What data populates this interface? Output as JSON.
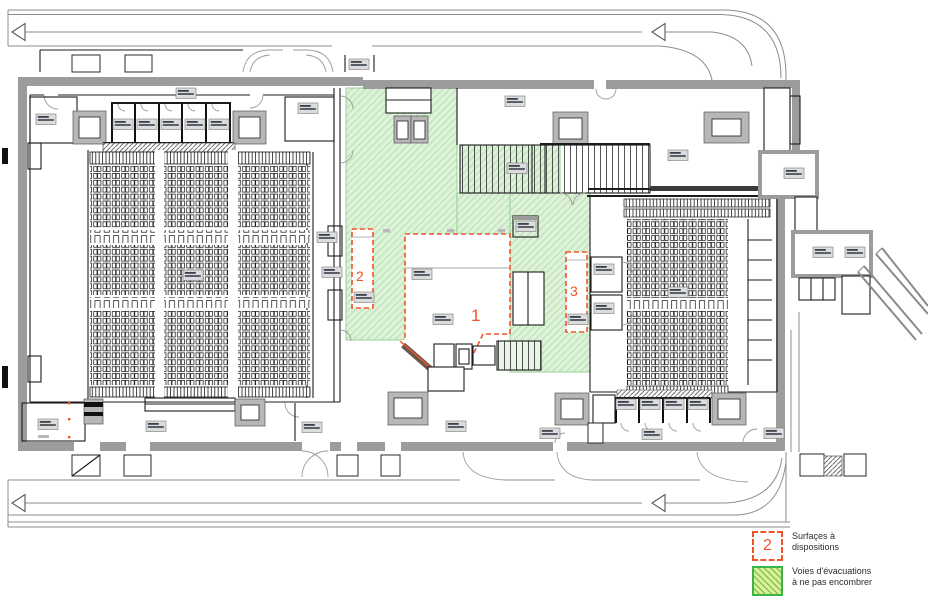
{
  "title": "Plan d'étage - salles et voies d'évacuation",
  "legend": {
    "surface": {
      "symbol": "2",
      "label": "Surfaçes à dispositions"
    },
    "evacuation": {
      "label": "Voies d'évacuations à ne pas encombrer"
    }
  },
  "zones": [
    {
      "number": "1"
    },
    {
      "number": "2"
    },
    {
      "number": "3"
    }
  ],
  "colors": {
    "accent_orange": "#f0542a",
    "green_fill": "#def2da",
    "green_hatch": "#b9e4b4",
    "green_border": "#8fcf8f",
    "legend_green_fill": "#d9efa4",
    "legend_green_hatch": "#8cc63f",
    "legend_green_border": "#39b54a",
    "wall_gray": "#9c9c9c",
    "chip_bg": "#dcdcdc"
  }
}
